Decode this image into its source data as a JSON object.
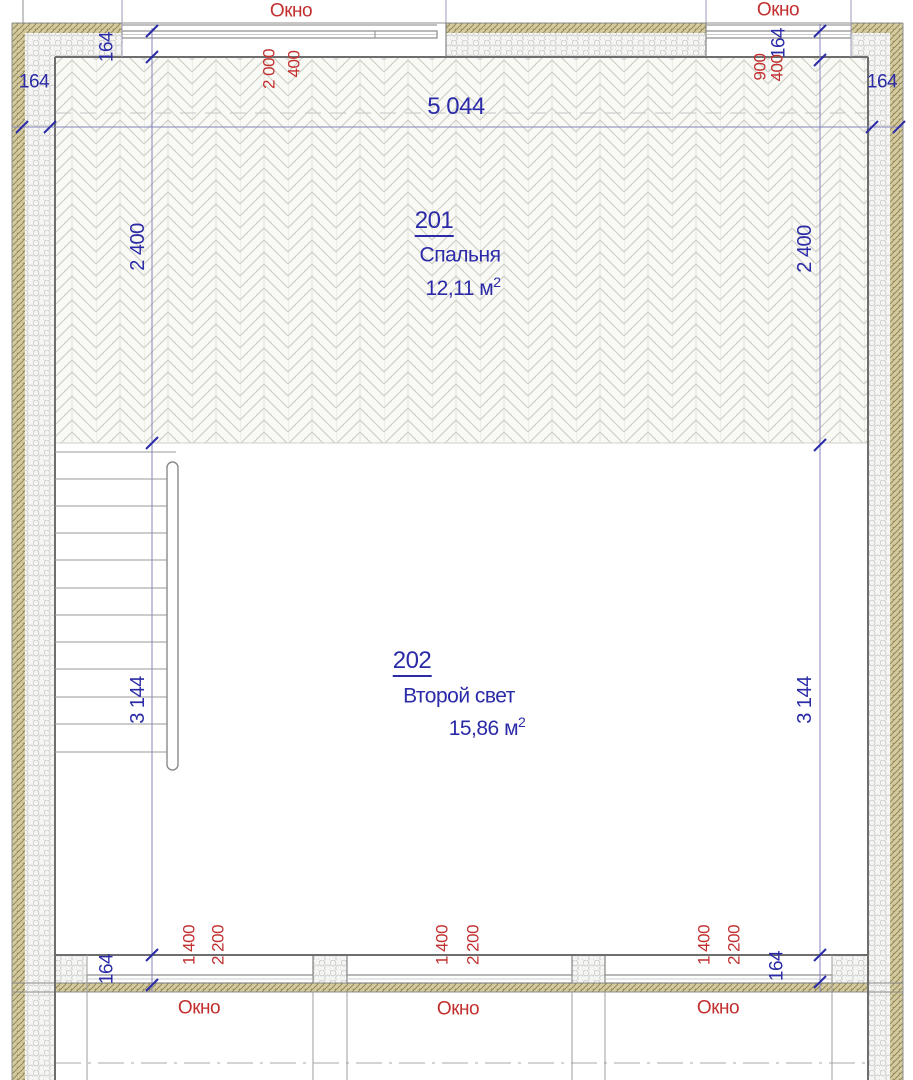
{
  "drawing": {
    "labels": {
      "window": "Окно"
    },
    "rooms": [
      {
        "number": "201",
        "name": "Спальня",
        "area": "12,11 м",
        "area_exp": "2"
      },
      {
        "number": "202",
        "name": "Второй свет",
        "area": "15,86 м",
        "area_exp": "2"
      }
    ],
    "dims": {
      "overall_width": "5 044",
      "left_chain": {
        "room_depth": "2 400",
        "hall_depth": "3 144",
        "wall_top": "164",
        "wall_side": "164",
        "wall_bottom": "164"
      },
      "right_chain": {
        "room_depth": "2 400",
        "hall_depth": "3 144",
        "wall_top": "164",
        "wall_side": "164",
        "wall_bottom": "164"
      },
      "top_windows": {
        "left_width": "2 000",
        "left_offset": "400",
        "right_width": "900",
        "right_offset": "400"
      },
      "bottom_windows": [
        {
          "width": "1 400",
          "height": "2 200"
        },
        {
          "width": "1 400",
          "height": "2 200"
        },
        {
          "width": "1 400",
          "height": "2 200"
        }
      ]
    },
    "colors": {
      "dim_blue": "#2b2ba8",
      "annot_red": "#c22f2f",
      "wall_tan": "#d4ca9f"
    }
  }
}
